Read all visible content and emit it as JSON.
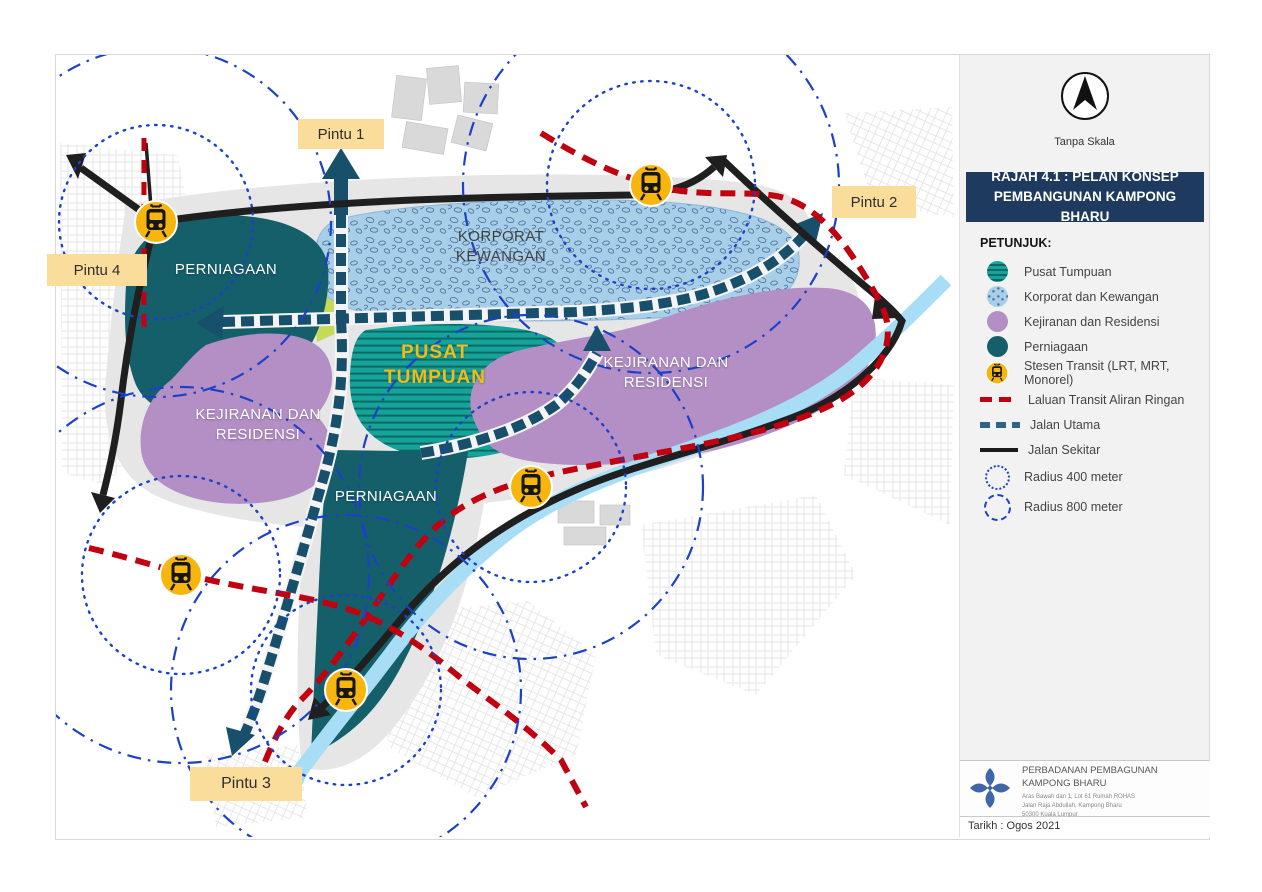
{
  "scale_note": "Tanpa Skala",
  "title": "RAJAH 4.1 : PELAN KONSEP PEMBANGUNAN KAMPONG BHARU",
  "legend": {
    "heading": "PETUNJUK:",
    "items": [
      {
        "id": "pusat-tumpuan",
        "label": "Pusat Tumpuan"
      },
      {
        "id": "korporat-kewangan",
        "label": "Korporat dan Kewangan"
      },
      {
        "id": "kejiranan-residensi",
        "label": "Kejiranan dan Residensi"
      },
      {
        "id": "perniagaan",
        "label": "Perniagaan"
      },
      {
        "id": "stesen-transit",
        "label": "Stesen Transit (LRT, MRT, Monorel)"
      },
      {
        "id": "laluan-transit",
        "label": "Laluan Transit Aliran Ringan"
      },
      {
        "id": "jalan-utama",
        "label": "Jalan Utama"
      },
      {
        "id": "jalan-sekitar",
        "label": "Jalan Sekitar"
      },
      {
        "id": "radius-400",
        "label": "Radius 400 meter"
      },
      {
        "id": "radius-800",
        "label": "Radius 800 meter"
      }
    ]
  },
  "map": {
    "gates": [
      {
        "label": "Pintu 1"
      },
      {
        "label": "Pintu 2"
      },
      {
        "label": "Pintu 3"
      },
      {
        "label": "Pintu 4"
      }
    ],
    "zone_labels": [
      {
        "id": "perniagaan-nw",
        "label": "PERNIAGAAN"
      },
      {
        "id": "korporat-kewangan",
        "label": "KORPORAT KEWANGAN"
      },
      {
        "id": "pusat-tumpuan",
        "label": "PUSAT TUMPUAN"
      },
      {
        "id": "kejiranan-barat",
        "label": "KEJIRANAN DAN RESIDENSI"
      },
      {
        "id": "kejiranan-timur",
        "label": "KEJIRANAN DAN RESIDENSI"
      },
      {
        "id": "perniagaan-tengah",
        "label": "PERNIAGAAN"
      }
    ]
  },
  "footer": {
    "organization": "PERBADANAN PEMBAGUNAN KAMPONG BHARU",
    "address_line1": "Aras Bawah dan 1, Lot 61 Rumah ROHAS",
    "address_line2": "Jalan Raja Abdullah, Kampong Bharu",
    "address_line3": "50300 Kuala Lumpur",
    "logo_caption": "KAMPONG BHARU",
    "date": "Tarikh : Ogos 2021"
  },
  "colors": {
    "navy_title": "#1e3a5f",
    "pusat_teal": "#16a39b",
    "perniagaan_teal": "#155f6b",
    "kejiranan_purple": "#b38fc6",
    "korporat_blue": "#a8cfe9",
    "station_yellow": "#f6b60e",
    "transit_red": "#c10010",
    "jalan_utama_blue": "#184f6b",
    "radius_blue": "#1c41c7",
    "gate_label_bg": "#fbdd9b",
    "river_blue": "#a8ddf6"
  }
}
